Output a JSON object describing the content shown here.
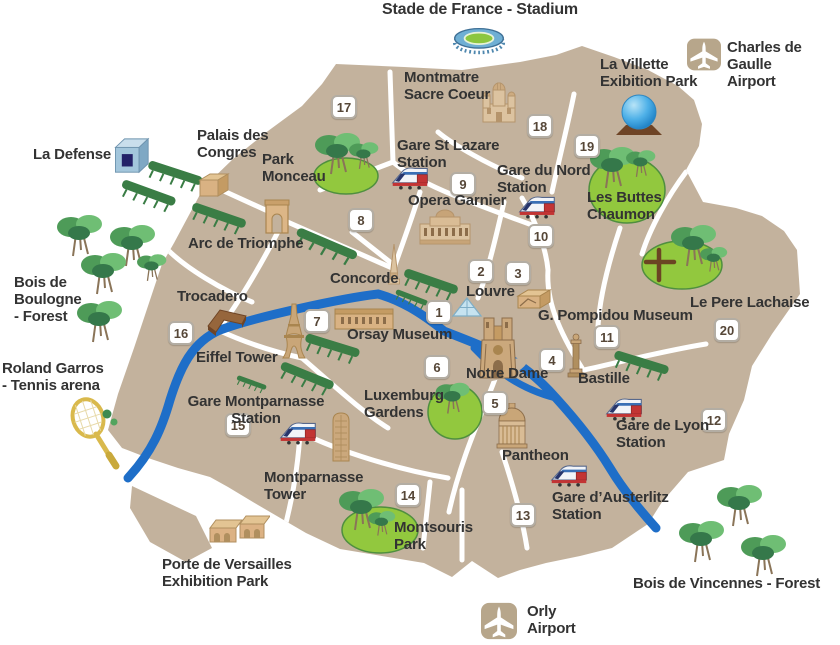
{
  "map": {
    "background_color": "#FFFFFF",
    "land_color": "#C3B29D",
    "road_color": "#FFFFFF",
    "river_color": "#1E6EC8",
    "park_color": "#92C83E",
    "labels": [
      {
        "id": "stade",
        "text": "Stade de France - Stadium",
        "x": 480,
        "y": 1,
        "anchor": "middle",
        "size": 16
      },
      {
        "id": "cdg",
        "text": "Charles de Gaulle\nAirport",
        "x": 727,
        "y": 40
      },
      {
        "id": "villette",
        "text": "La Villette\nExibition Park",
        "x": 600,
        "y": 57
      },
      {
        "id": "montmatre",
        "text": "Montmatre\nSacre Coeur",
        "x": 404,
        "y": 70
      },
      {
        "id": "defense",
        "text": "La Defense",
        "x": 33,
        "y": 147
      },
      {
        "id": "palais",
        "text": "Palais des\nCongres",
        "x": 197,
        "y": 128
      },
      {
        "id": "monceau",
        "text": "Park\nMonceau",
        "x": 262,
        "y": 152
      },
      {
        "id": "lazare",
        "text": "Gare St Lazare\nStation",
        "x": 397,
        "y": 138
      },
      {
        "id": "opera",
        "text": "Opera Garnier",
        "x": 408,
        "y": 193
      },
      {
        "id": "nord",
        "text": "Gare du Nord\nStation",
        "x": 497,
        "y": 163
      },
      {
        "id": "buttes",
        "text": "Les Buttes\nChaumon",
        "x": 587,
        "y": 190
      },
      {
        "id": "arc",
        "text": "Arc de Triomphe",
        "x": 188,
        "y": 236
      },
      {
        "id": "boulogne",
        "text": "Bois de\nBoulogne\n- Forest",
        "x": 14,
        "y": 275
      },
      {
        "id": "concorde",
        "text": "Concorde",
        "x": 330,
        "y": 271
      },
      {
        "id": "louvre",
        "text": "Louvre",
        "x": 466,
        "y": 284
      },
      {
        "id": "lachaise",
        "text": "Le Pere Lachaise",
        "x": 690,
        "y": 295
      },
      {
        "id": "trocadero",
        "text": "Trocadero",
        "x": 177,
        "y": 289
      },
      {
        "id": "pompidou",
        "text": "G. Pompidou Museum",
        "x": 538,
        "y": 308
      },
      {
        "id": "orsay",
        "text": "Orsay Museum",
        "x": 347,
        "y": 327
      },
      {
        "id": "eiffel",
        "text": "Eiffel Tower",
        "x": 196,
        "y": 350
      },
      {
        "id": "notredame",
        "text": "Notre Dame",
        "x": 466,
        "y": 366
      },
      {
        "id": "bastille",
        "text": "Bastille",
        "x": 578,
        "y": 371
      },
      {
        "id": "roland",
        "text": "Roland Garros\n- Tennis arena",
        "x": 2,
        "y": 361
      },
      {
        "id": "gare-montparnasse",
        "text": "Gare Montparnasse\nStation",
        "x": 256,
        "y": 394,
        "anchor": "middle"
      },
      {
        "id": "luxemburg",
        "text": "Luxemburg\nGardens",
        "x": 364,
        "y": 388
      },
      {
        "id": "gare-lyon",
        "text": "Gare de Lyon\nStation",
        "x": 616,
        "y": 418
      },
      {
        "id": "montparnasse-tower",
        "text": "Montparnasse\nTower",
        "x": 264,
        "y": 470
      },
      {
        "id": "pantheon",
        "text": "Pantheon",
        "x": 502,
        "y": 448
      },
      {
        "id": "austerlitz",
        "text": "Gare d’Austerlitz\nStation",
        "x": 552,
        "y": 490
      },
      {
        "id": "montsouris",
        "text": "Montsouris\nPark",
        "x": 394,
        "y": 520
      },
      {
        "id": "versailles",
        "text": "Porte de Versailles\nExhibition Park",
        "x": 162,
        "y": 557
      },
      {
        "id": "vincennes",
        "text": "Bois de Vincennes - Forest",
        "x": 633,
        "y": 576
      },
      {
        "id": "orly",
        "text": "Orly\nAirport",
        "x": 527,
        "y": 604
      }
    ],
    "badges": [
      {
        "n": "1",
        "x": 439,
        "y": 312
      },
      {
        "n": "2",
        "x": 481,
        "y": 271
      },
      {
        "n": "3",
        "x": 518,
        "y": 273
      },
      {
        "n": "4",
        "x": 552,
        "y": 360
      },
      {
        "n": "5",
        "x": 495,
        "y": 403
      },
      {
        "n": "6",
        "x": 437,
        "y": 367
      },
      {
        "n": "7",
        "x": 317,
        "y": 321
      },
      {
        "n": "8",
        "x": 361,
        "y": 220
      },
      {
        "n": "9",
        "x": 463,
        "y": 184
      },
      {
        "n": "10",
        "x": 541,
        "y": 236
      },
      {
        "n": "11",
        "x": 607,
        "y": 337
      },
      {
        "n": "12",
        "x": 714,
        "y": 420
      },
      {
        "n": "13",
        "x": 523,
        "y": 515
      },
      {
        "n": "14",
        "x": 408,
        "y": 495
      },
      {
        "n": "15",
        "x": 238,
        "y": 425
      },
      {
        "n": "16",
        "x": 181,
        "y": 333
      },
      {
        "n": "17",
        "x": 344,
        "y": 107
      },
      {
        "n": "18",
        "x": 540,
        "y": 126
      },
      {
        "n": "19",
        "x": 587,
        "y": 146
      },
      {
        "n": "20",
        "x": 727,
        "y": 330
      }
    ],
    "icons": [
      {
        "name": "stadium-icon",
        "type": "stadium",
        "x": 452,
        "y": 26,
        "w": 54,
        "h": 30
      },
      {
        "name": "cdg-airplane-icon",
        "type": "plane",
        "x": 687,
        "y": 37,
        "w": 34,
        "h": 35
      },
      {
        "name": "geode-sphere-icon",
        "type": "geode",
        "x": 608,
        "y": 93,
        "w": 62,
        "h": 46
      },
      {
        "name": "la-defense-cube-icon",
        "type": "cube",
        "x": 110,
        "y": 136,
        "w": 40,
        "h": 40
      },
      {
        "name": "palais-des-congres-icon",
        "type": "building3d",
        "x": 198,
        "y": 172,
        "w": 32,
        "h": 26
      },
      {
        "name": "arc-de-triomphe-icon",
        "type": "arch",
        "x": 263,
        "y": 198,
        "w": 28,
        "h": 38
      },
      {
        "name": "sacre-coeur-icon",
        "type": "sacrecoeur",
        "x": 477,
        "y": 80,
        "w": 44,
        "h": 44
      },
      {
        "name": "gare-st-lazare-train-icon",
        "type": "train",
        "x": 390,
        "y": 163,
        "w": 40,
        "h": 27
      },
      {
        "name": "opera-garnier-icon",
        "type": "opera",
        "x": 418,
        "y": 208,
        "w": 54,
        "h": 38
      },
      {
        "name": "gare-du-nord-train-icon",
        "type": "train",
        "x": 517,
        "y": 192,
        "w": 40,
        "h": 27
      },
      {
        "name": "concorde-obelisk-icon",
        "type": "obelisk",
        "x": 385,
        "y": 243,
        "w": 18,
        "h": 46
      },
      {
        "name": "louvre-pyramid-icon",
        "type": "pyramid",
        "x": 452,
        "y": 296,
        "w": 30,
        "h": 22
      },
      {
        "name": "pompidou-museum-icon",
        "type": "pompidou",
        "x": 516,
        "y": 288,
        "w": 36,
        "h": 22
      },
      {
        "name": "notre-dame-icon",
        "type": "cathedral",
        "x": 478,
        "y": 314,
        "w": 40,
        "h": 70
      },
      {
        "name": "bastille-column-icon",
        "type": "column",
        "x": 566,
        "y": 333,
        "w": 20,
        "h": 46
      },
      {
        "name": "trocadero-icon",
        "type": "trocadero",
        "x": 204,
        "y": 304,
        "w": 44,
        "h": 36
      },
      {
        "name": "eiffel-tower-icon",
        "type": "eiffel",
        "x": 278,
        "y": 302,
        "w": 32,
        "h": 60
      },
      {
        "name": "orsay-museum-icon",
        "type": "orsay",
        "x": 333,
        "y": 305,
        "w": 62,
        "h": 26
      },
      {
        "name": "pantheon-icon",
        "type": "pantheon",
        "x": 494,
        "y": 403,
        "w": 36,
        "h": 46
      },
      {
        "name": "gare-montparnasse-train-icon",
        "type": "train",
        "x": 278,
        "y": 418,
        "w": 40,
        "h": 27
      },
      {
        "name": "montparnasse-tower-icon",
        "type": "tower",
        "x": 327,
        "y": 411,
        "w": 28,
        "h": 54
      },
      {
        "name": "gare-de-lyon-train-icon",
        "type": "train",
        "x": 604,
        "y": 394,
        "w": 40,
        "h": 27
      },
      {
        "name": "gare-austerlitz-train-icon",
        "type": "train",
        "x": 549,
        "y": 461,
        "w": 40,
        "h": 26
      },
      {
        "name": "porte-de-versailles-icon",
        "type": "sheds",
        "x": 208,
        "y": 512,
        "w": 62,
        "h": 38
      },
      {
        "name": "tennis-racket-icon",
        "type": "racket",
        "x": 62,
        "y": 396,
        "w": 70,
        "h": 78
      },
      {
        "name": "orly-airplane-icon",
        "type": "plane",
        "x": 481,
        "y": 601,
        "w": 36,
        "h": 40
      }
    ]
  }
}
